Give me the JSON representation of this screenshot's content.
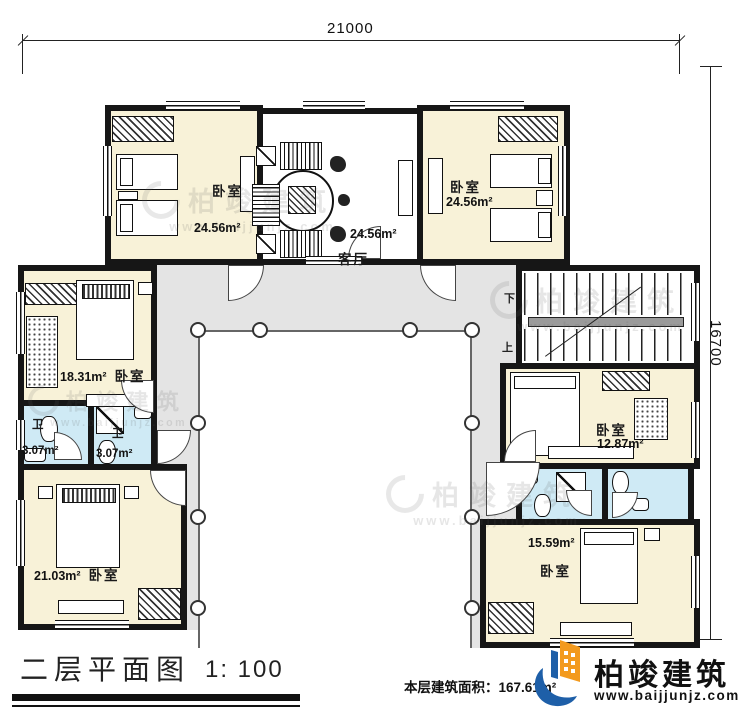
{
  "plan": {
    "dim_top": "21000",
    "dim_right": "16700",
    "rooms": {
      "bedroom_tl": {
        "name": "卧室",
        "area": "24.56m²"
      },
      "living": {
        "name": "客厅",
        "area": "24.56m²"
      },
      "bedroom_tr": {
        "name": "卧室",
        "area": "24.56m²"
      },
      "bedroom_ml": {
        "name": "卧室",
        "area": "18.31m²"
      },
      "bath_left_1": {
        "name": "卫",
        "area": "3.07m²"
      },
      "bath_left_2": {
        "name": "卫",
        "area": "3.07m²"
      },
      "bedroom_bl": {
        "name": "卧室",
        "area": "21.03m²"
      },
      "bedroom_mr": {
        "name": "卧室",
        "area": "12.87m²"
      },
      "bedroom_br": {
        "name": "卧室",
        "area": "15.59m²"
      }
    },
    "stairs": {
      "down_label": "下",
      "up_label": "上"
    }
  },
  "titleblock": {
    "plan_title": "二层平面图",
    "scale": "1: 100",
    "floor_area": "本层建筑面积：167.61m²"
  },
  "brand": {
    "name": "柏竣建筑",
    "website": "www.baijjunjz.com"
  }
}
